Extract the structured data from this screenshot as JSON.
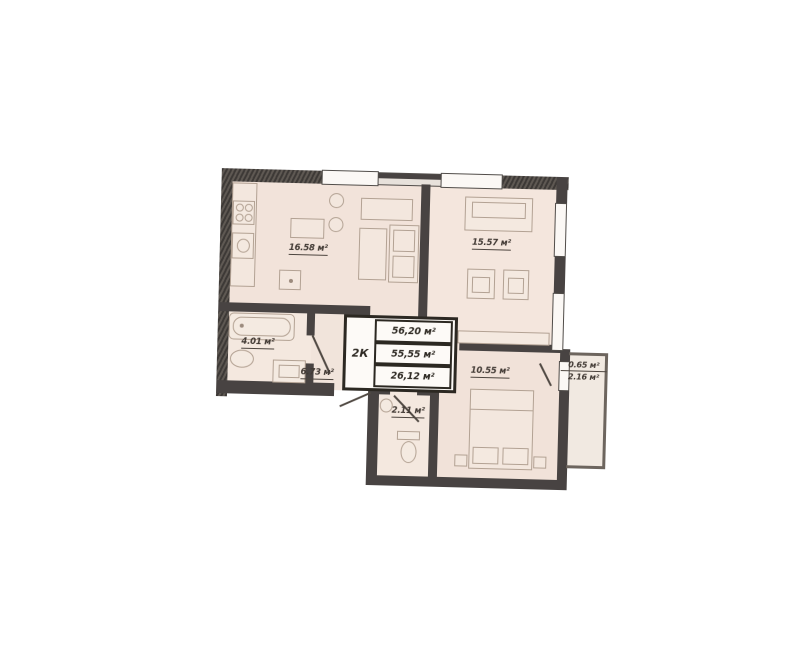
{
  "unit": {
    "type_label": "2К"
  },
  "summary": {
    "rows": [
      "56,20 м²",
      "55,55 м²",
      "26,12 м²"
    ]
  },
  "rooms": {
    "kitchen_living": {
      "area": "16.58 м²"
    },
    "living_room": {
      "area": "15.57 м²"
    },
    "bathroom": {
      "area": "4.01 м²"
    },
    "hallway": {
      "area": "6.73 м²"
    },
    "bedroom": {
      "area": "10.55 м²"
    },
    "wc": {
      "area": "2.11 м²"
    },
    "balcony": {
      "area_counted": "0.65 м²",
      "area_full": "2.16 м²"
    }
  },
  "colors": {
    "wall": "#454140",
    "floor_fill": "#f3e4dd",
    "furniture_line": "#b2a193",
    "background": "#ffffff"
  }
}
